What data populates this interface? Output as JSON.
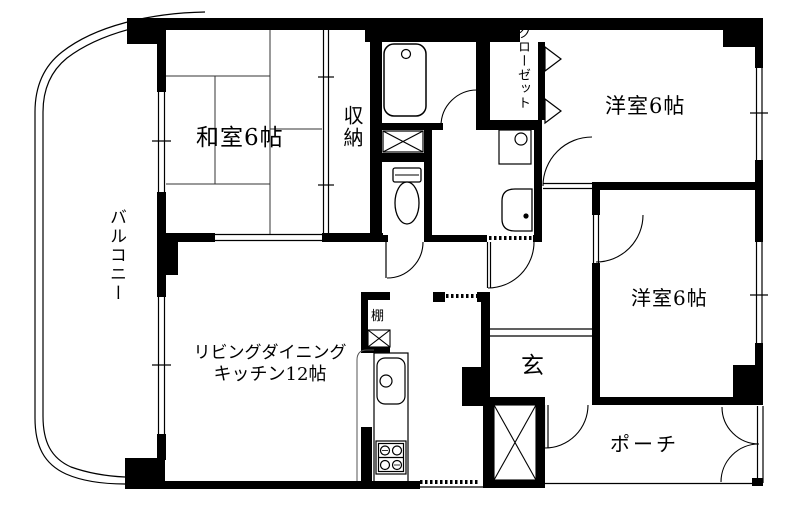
{
  "plan": {
    "title": "apartment-floor-plan",
    "colors": {
      "background": "#ffffff",
      "wall": "#000000",
      "line": "#1a1a1a"
    },
    "rooms": {
      "washitsu": {
        "label": "和室6帖"
      },
      "shunou": {
        "label": "収納"
      },
      "closet": {
        "label": "クローゼット"
      },
      "bedroom_top": {
        "label": "洋室6帖"
      },
      "bedroom_right": {
        "label": "洋室6帖"
      },
      "ldk": {
        "label_line1": "リビングダイニング",
        "label_line2": "キッチン12帖"
      },
      "genkan": {
        "label": "玄"
      },
      "porch": {
        "label": "ポーチ"
      },
      "balcony": {
        "label": "バルコニー"
      },
      "shelf": {
        "label": "棚"
      }
    },
    "fixtures": [
      "bathtub",
      "toilet",
      "washbasin",
      "washing-machine-pan",
      "kitchen-sink",
      "gas-stove",
      "pipe-space",
      "duct-shaft",
      "shelf-box"
    ]
  }
}
